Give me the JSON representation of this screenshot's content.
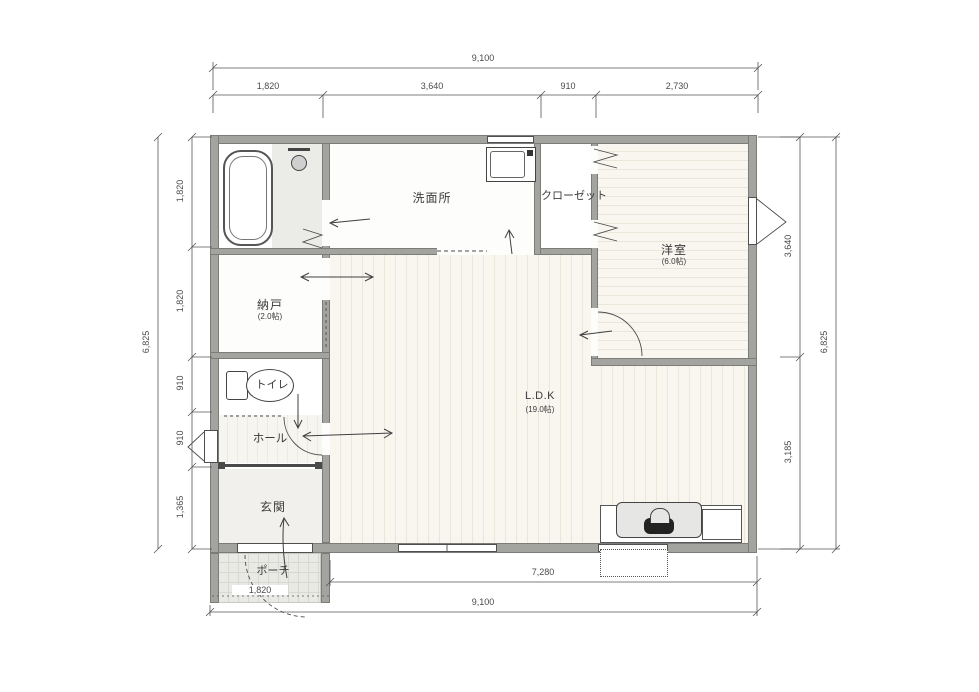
{
  "rooms": {
    "washroom": {
      "label": "洗面所"
    },
    "closet": {
      "label": "クローゼット"
    },
    "western_room": {
      "label": "洋室",
      "size": "(6.0帖)"
    },
    "storage": {
      "label": "納戸",
      "size": "(2.0帖)"
    },
    "toilet": {
      "label": "トイレ"
    },
    "hall": {
      "label": "ホール"
    },
    "entrance": {
      "label": "玄関"
    },
    "porch": {
      "label": "ポーチ"
    },
    "ldk": {
      "label": "L.D.K",
      "size": "(19.0帖)"
    }
  },
  "dimensions": {
    "top": {
      "total": "9,100",
      "segments": [
        "1,820",
        "3,640",
        "910",
        "2,730"
      ]
    },
    "left": {
      "total": "6,825",
      "segments": [
        "1,820",
        "1,820",
        "910",
        "910",
        "1,365"
      ]
    },
    "right": {
      "total": "6,825",
      "segments": [
        "3,640",
        "3,185"
      ]
    },
    "bottom": {
      "main": "7,280",
      "total": "9,100",
      "porch": "1,820"
    }
  },
  "colors": {
    "wall": "#a3a3a0",
    "floor_wood": "#f8f6ef",
    "porch": "#e9e9e5",
    "line": "#4a4a4a"
  }
}
